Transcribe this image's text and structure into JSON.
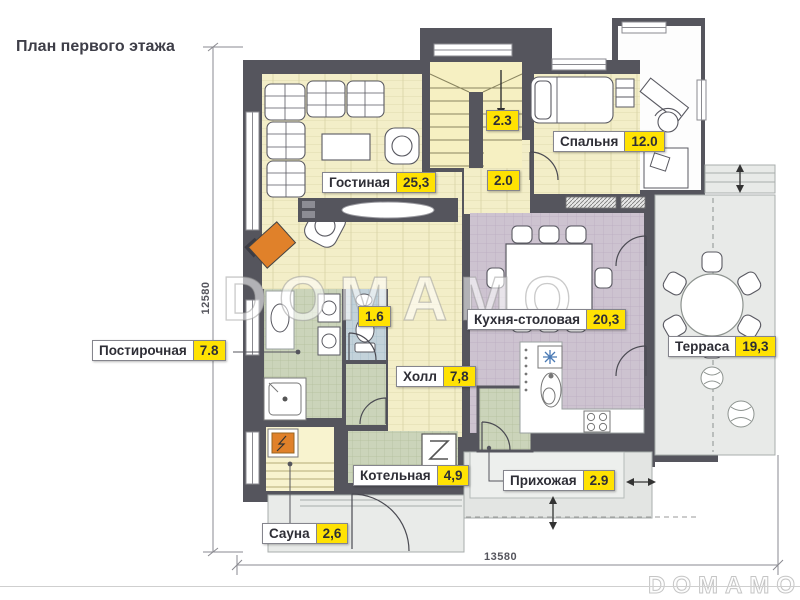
{
  "title": "План первого этажа",
  "watermark_text": "DOMAMO",
  "brand_logo": "DOMAMO",
  "dimensions": {
    "height_mm": "12580",
    "width_mm": "13580"
  },
  "rooms": {
    "living": {
      "name": "Гостиная",
      "area": "25,3"
    },
    "bedroom": {
      "name": "Спальня",
      "area": "12.0"
    },
    "kitchen": {
      "name": "Кухня-столовая",
      "area": "20,3"
    },
    "terrace": {
      "name": "Терраса",
      "area": "19,3"
    },
    "laundry": {
      "name": "Постирочная",
      "area": "7.8"
    },
    "hall": {
      "name": "Холл",
      "area": "7,8"
    },
    "boiler": {
      "name": "Котельная",
      "area": "4,9"
    },
    "entry": {
      "name": "Прихожая",
      "area": "2.9"
    },
    "sauna": {
      "name": "Сауна",
      "area": "2,6"
    },
    "stairs": {
      "area": "2.3"
    },
    "landing": {
      "area": "2.0"
    },
    "wc": {
      "area": "1.6"
    }
  },
  "colors": {
    "accent_yellow": "#ffe203",
    "wall": "#55555d",
    "fireplace_orange": "#e0812a",
    "wood_floor": "#f3eec8",
    "kitchen_tile": "#cdc3d0",
    "utility_tile": "#cbd4ba",
    "wc_tile": "#c3d2da",
    "terrace_floor": "#e8eae8"
  }
}
